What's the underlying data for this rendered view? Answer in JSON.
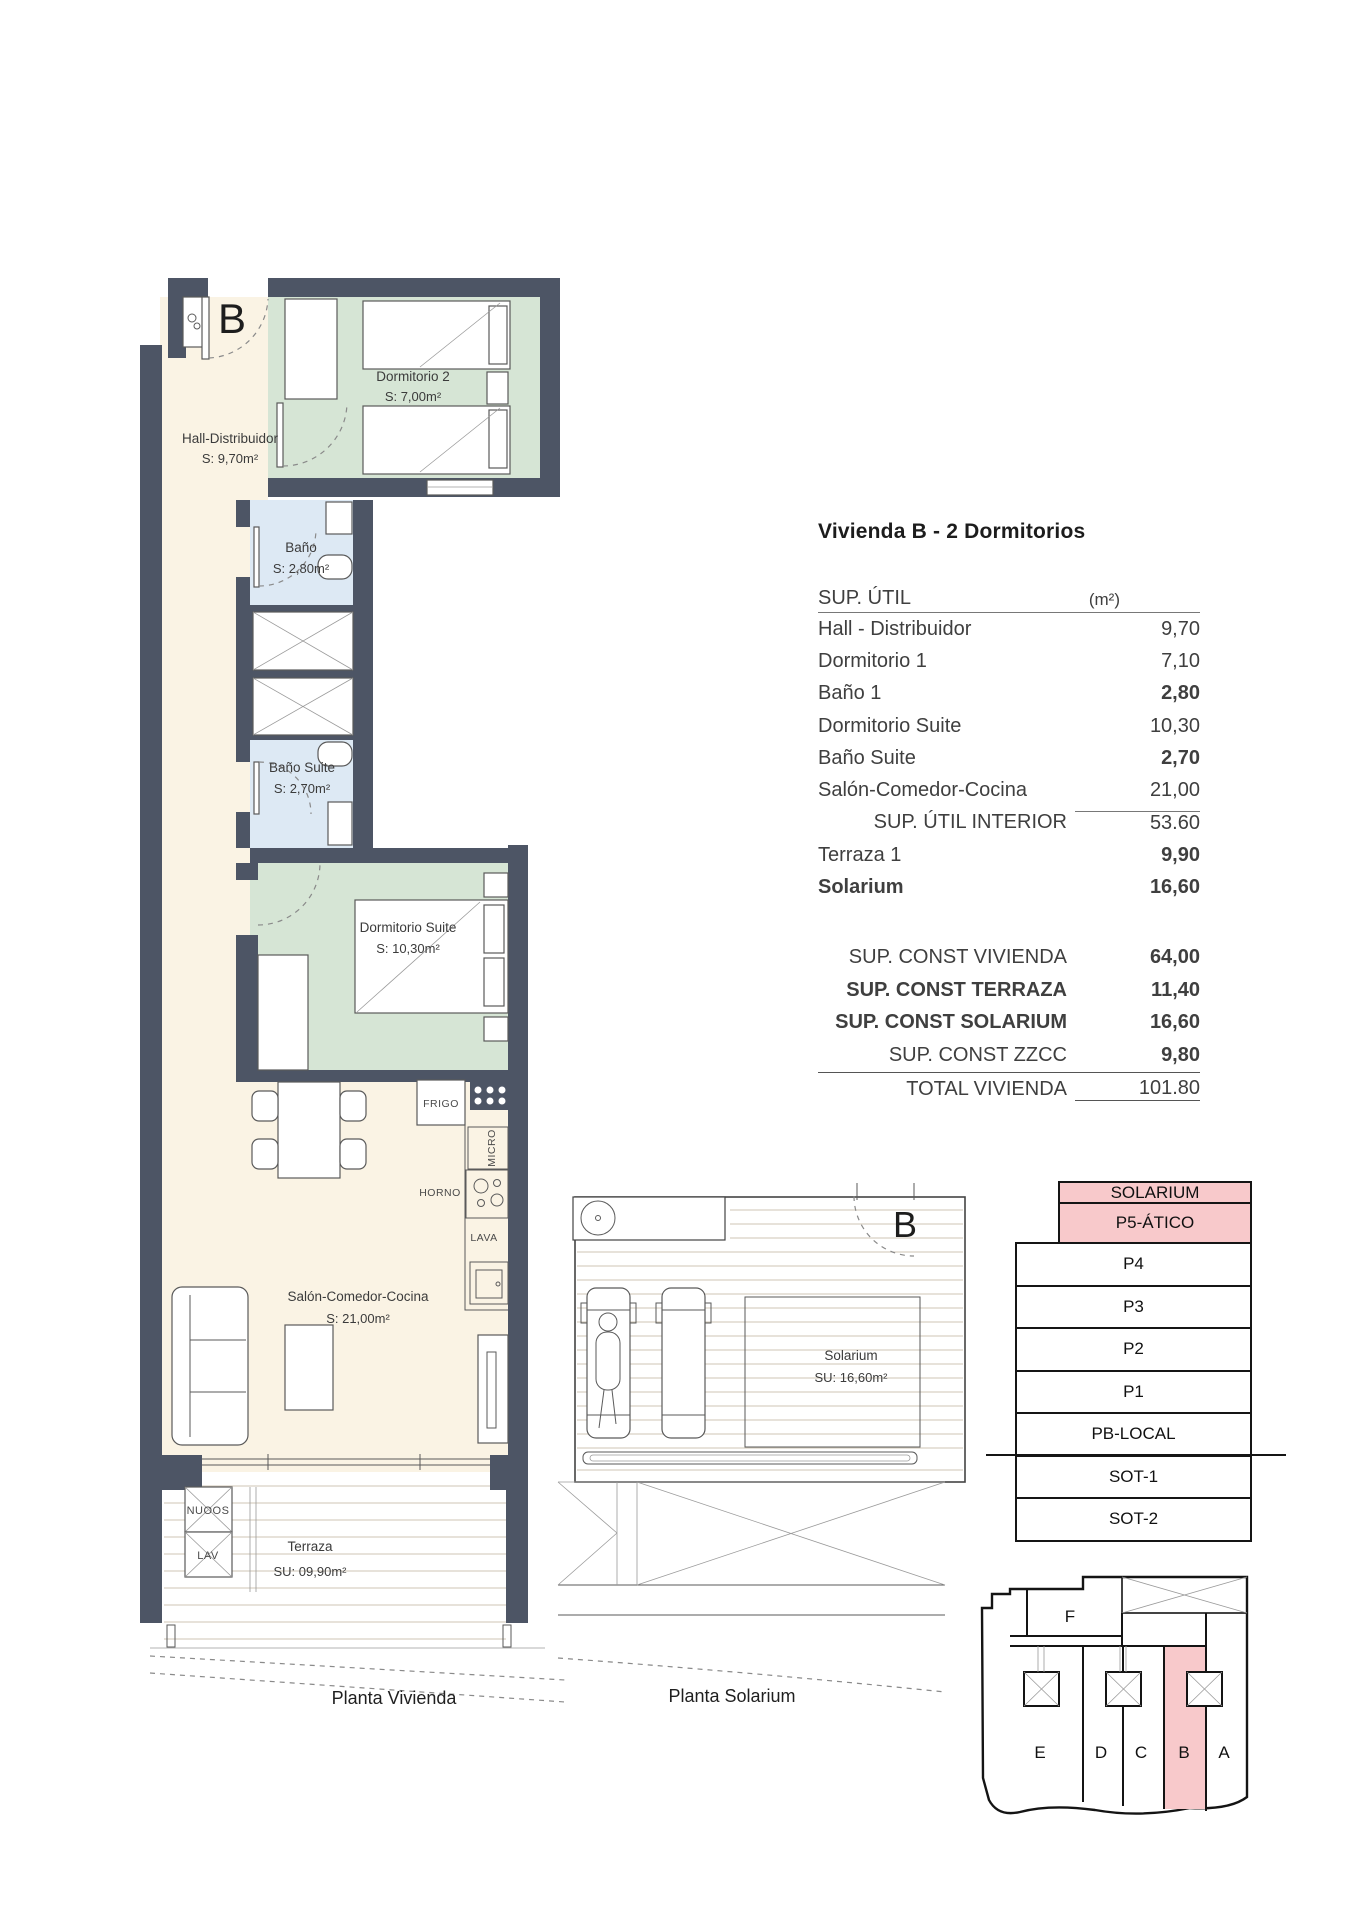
{
  "title": "Vivienda B - 2 Dormitorios",
  "unit_letter": "B",
  "captions": {
    "vivienda": "Planta Vivienda",
    "solarium": "Planta Solarium"
  },
  "surface_table": {
    "header": {
      "label": "SUP. ÚTIL",
      "unit": "(m²)"
    },
    "rows": [
      {
        "label": "Hall - Distribuidor",
        "value": "9,70"
      },
      {
        "label": "Dormitorio 1",
        "value": "7,10"
      },
      {
        "label": "Baño 1",
        "value": "2,80"
      },
      {
        "label": "Dormitorio Suite",
        "value": "10,30"
      },
      {
        "label": "Baño Suite",
        "value": "2,70"
      },
      {
        "label": "Salón-Comedor-Cocina",
        "value": "21,00"
      },
      {
        "label": "SUP. ÚTIL INTERIOR",
        "value": "53.60"
      },
      {
        "label": "Terraza 1",
        "value": "9,90"
      },
      {
        "label": "Solarium",
        "value": "16,60"
      }
    ],
    "totals": [
      {
        "label": "SUP. CONST VIVIENDA",
        "value": "64,00"
      },
      {
        "label": "SUP. CONST TERRAZA",
        "value": "11,40"
      },
      {
        "label": "SUP. CONST SOLARIUM",
        "value": "16,60"
      },
      {
        "label": "SUP. CONST ZZCC",
        "value": "9,80"
      },
      {
        "label": "TOTAL VIVIENDA",
        "value": "101.80"
      }
    ]
  },
  "plan_vivienda": {
    "rooms": {
      "hall": {
        "name": "Hall-Distribuidor",
        "area": "S: 9,70m²"
      },
      "dormitorio2": {
        "name": "Dormitorio 2",
        "area": "S: 7,00m²"
      },
      "bano": {
        "name": "Baño",
        "area": "S: 2,80m²"
      },
      "bano_suite": {
        "name": "Baño Suite",
        "area": "S: 2,70m²"
      },
      "dormitorio_suite": {
        "name": "Dormitorio Suite",
        "area": "S: 10,30m²"
      },
      "salon": {
        "name": "Salón-Comedor-Cocina",
        "area": "S: 21,00m²"
      },
      "terraza": {
        "name": "Terraza",
        "area": "SU: 09,90m²"
      }
    },
    "labels": {
      "frigo": "FRIGO",
      "micro": "MICRO",
      "horno": "HORNO",
      "lava": "LAVA",
      "nudos": "NUOOS",
      "lav": "LAV"
    }
  },
  "plan_solarium": {
    "room": {
      "name": "Solarium",
      "area": "SU: 16,60m²"
    }
  },
  "levels": {
    "items": [
      {
        "label": "SOLARIUM"
      },
      {
        "label": "P5-ÁTICO"
      },
      {
        "label": "P4"
      },
      {
        "label": "P3"
      },
      {
        "label": "P2"
      },
      {
        "label": "P1"
      },
      {
        "label": "PB-LOCAL"
      },
      {
        "label": "SOT-1"
      },
      {
        "label": "SOT-2"
      }
    ]
  },
  "site_plan": {
    "units": {
      "f": "F",
      "e": "E",
      "d": "D",
      "c": "C",
      "b": "B",
      "a": "A"
    }
  },
  "colors": {
    "wall": "#4d5565",
    "floor_cream": "#faf3e4",
    "room_green": "#d6e5d5",
    "room_blue": "#dde9f4",
    "highlight_pink": "#f8c9cb"
  }
}
